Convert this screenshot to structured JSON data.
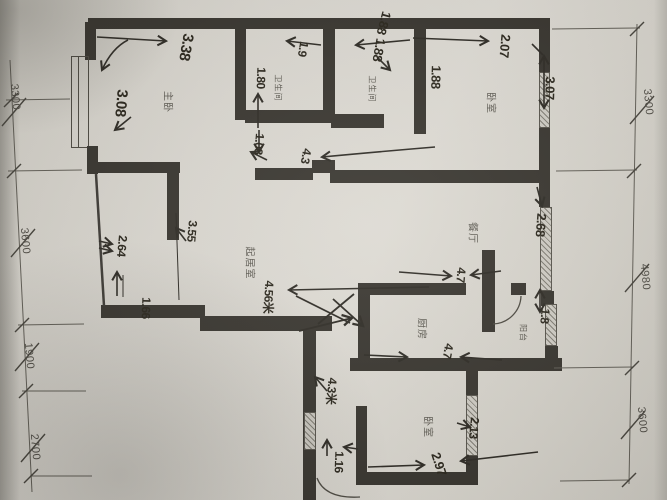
{
  "rooms": {
    "master_bedroom": {
      "label": "主卧"
    },
    "bathroom_1": {
      "label": "卫生间"
    },
    "bathroom_2": {
      "label": "卫生间"
    },
    "bedroom_top": {
      "label": "卧室"
    },
    "dining": {
      "label": "餐厅"
    },
    "living": {
      "label": "起居室"
    },
    "kitchen": {
      "label": "厨房"
    },
    "balcony": {
      "label": "阳台"
    },
    "bedroom_bottom": {
      "label": "卧室"
    }
  },
  "dimensions": {
    "left": [
      "3300",
      "3600",
      "1900",
      "2700"
    ],
    "right": [
      "3300",
      "4980",
      "3600"
    ]
  },
  "annotations": {
    "master_width": "3.38",
    "master_height": "3.08",
    "bath1_note": "1.9",
    "bath1_width": "1.80",
    "bath1_door": "1.08",
    "top_note": "1.88",
    "bath2_width": "1.88",
    "bath2_depth": "1.88",
    "bedroom_top_width": "2.07",
    "bedroom_top_depth": "3.07",
    "dining_depth": "2.68",
    "dining_width": "4.7",
    "kitchen_width": "4.7",
    "balcony_width": "1.8",
    "living_wall": "3.55",
    "living_left": "2.64",
    "living_corner": "1.66",
    "living_width": "4.56米",
    "hall_width": "4.3",
    "corridor_length": "4.3米",
    "corridor_width": "1.16",
    "bedroom_bottom_depth": "2.13",
    "bedroom_bottom_width": "2.97"
  },
  "colors": {
    "paper": "#d6d3cb",
    "wall": "#35322c",
    "ink": "#2b2720",
    "printed": "#5f5c54"
  }
}
